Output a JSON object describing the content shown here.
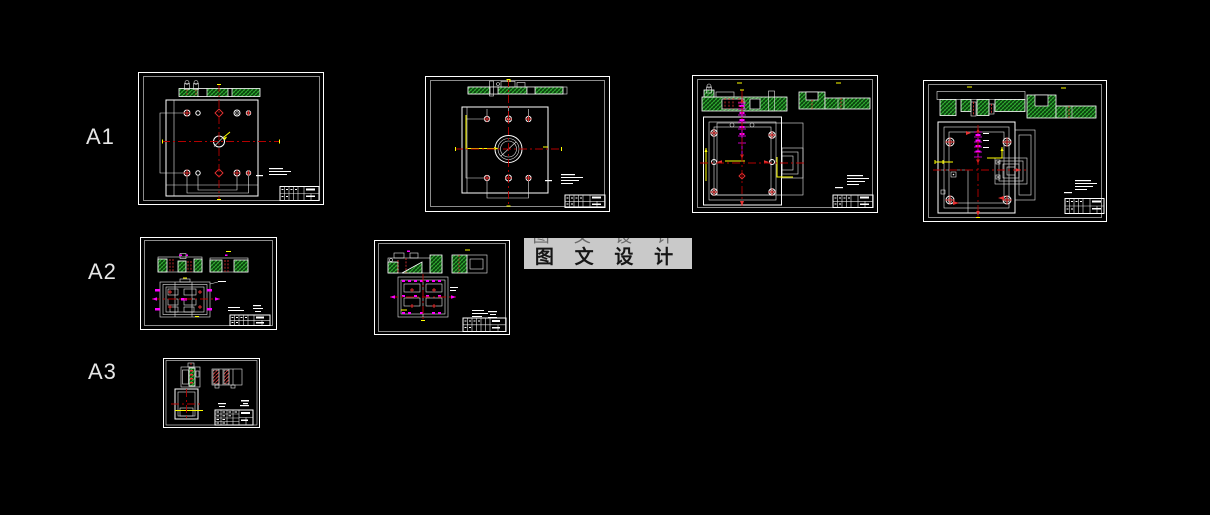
{
  "page": {
    "background": "#000000"
  },
  "rows": [
    {
      "label": "A1",
      "drawing_count": 4
    },
    {
      "label": "A2",
      "drawing_count": 2
    },
    {
      "label": "A3",
      "drawing_count": 1
    }
  ],
  "watermark": {
    "text": "图 文 设 计",
    "background_color": "#c9c9c9",
    "text_color": "#161616"
  },
  "palette": {
    "background_black": "#000000",
    "frame_white": "#ffffff",
    "hatch_green": "#35b435",
    "centerline_red": "#b40000",
    "highlight_red": "#e83232",
    "dimension_magenta": "#ff00ff",
    "leader_yellow": "#ffff00"
  },
  "drawings": [
    {
      "id": "a1-1",
      "row": "A1",
      "content": "plate-top-view-with-hatched-section"
    },
    {
      "id": "a1-2",
      "row": "A1",
      "content": "plate-with-center-bore-and-section"
    },
    {
      "id": "a1-3",
      "row": "A1",
      "content": "fixture-assembly-two-sections"
    },
    {
      "id": "a1-4",
      "row": "A1",
      "content": "fixture-assembly-variant"
    },
    {
      "id": "a2-1",
      "row": "A2",
      "content": "small-assembly-with-sections"
    },
    {
      "id": "a2-2",
      "row": "A2",
      "content": "small-assembly-variant"
    },
    {
      "id": "a3-1",
      "row": "A3",
      "content": "part-detail-views"
    }
  ]
}
